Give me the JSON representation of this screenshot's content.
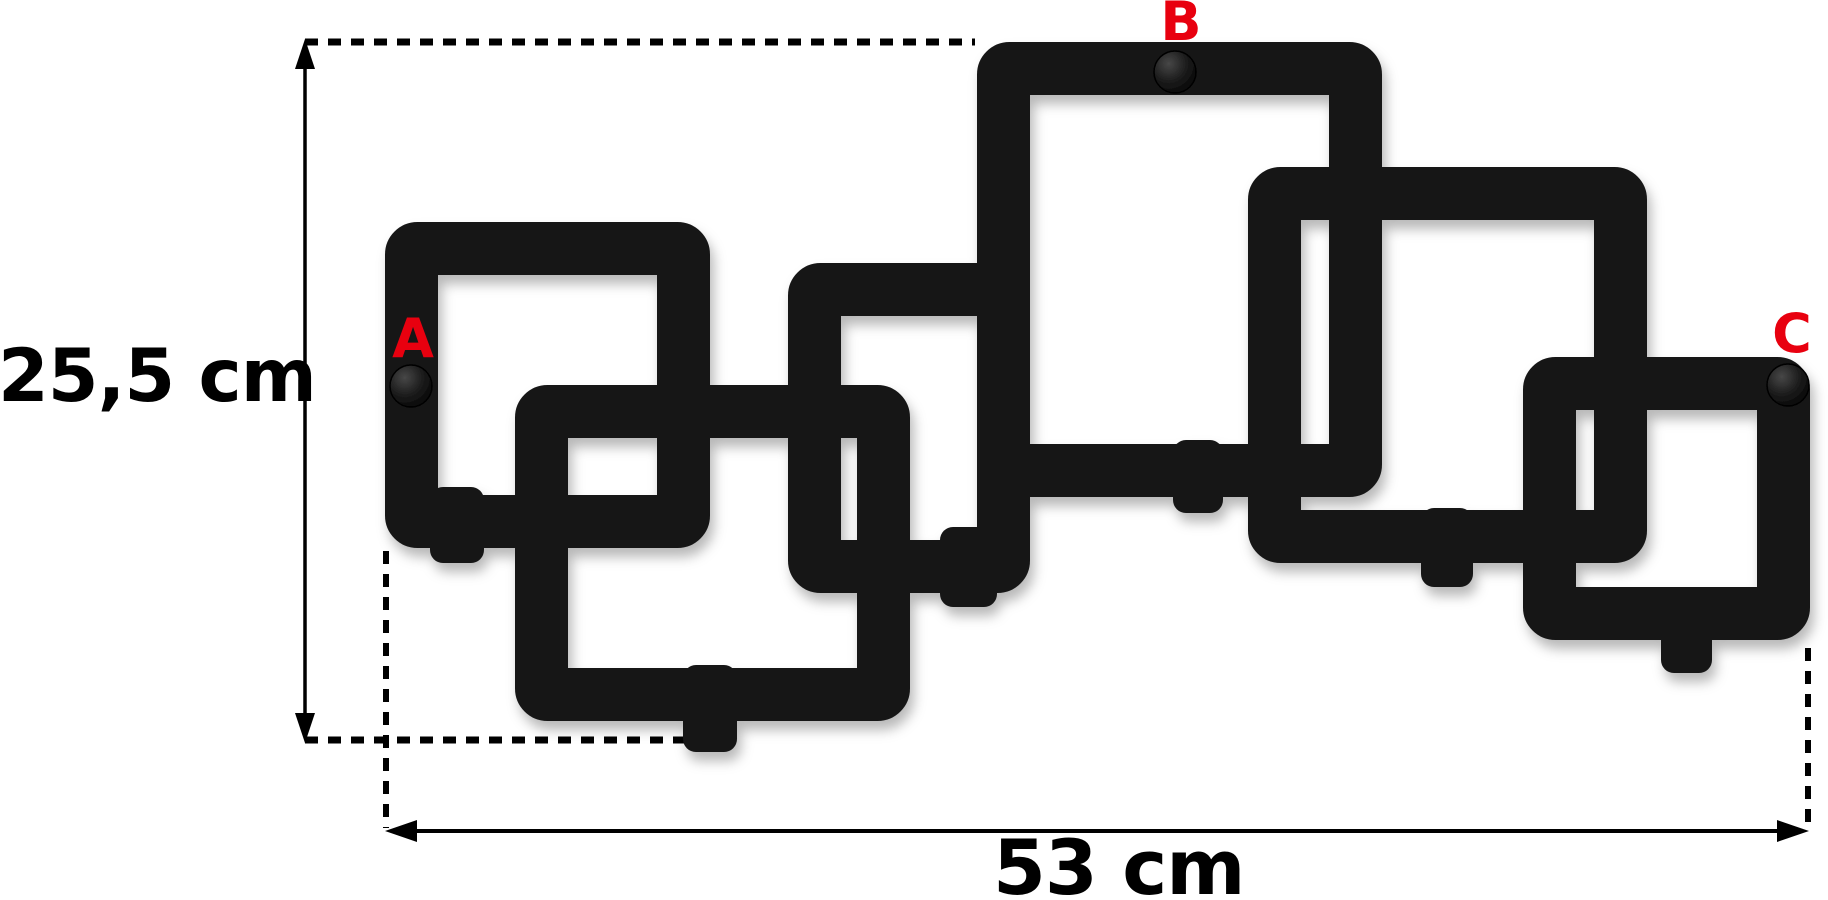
{
  "canvas": {
    "width": 1828,
    "height": 900,
    "background": "#ffffff"
  },
  "colors": {
    "metal": "#161616",
    "label_red": "#e8000f",
    "dimension_line": "#000000",
    "text": "#000000"
  },
  "dimensions": {
    "height_label": "25,5 cm",
    "width_label": "53 cm"
  },
  "mount_points": [
    {
      "label": "A",
      "label_x": 413,
      "label_y": 339,
      "screw_x": 411,
      "screw_y": 386
    },
    {
      "label": "B",
      "label_x": 1181,
      "label_y": 22,
      "screw_x": 1175,
      "screw_y": 72
    },
    {
      "label": "C",
      "label_x": 1792,
      "label_y": 334,
      "screw_x": 1788,
      "screw_y": 385
    }
  ],
  "artwork": {
    "description": "wall coat rack made of six interlocking square frames with hooks",
    "bar_thickness": 53,
    "corner_radius": 6,
    "screw_radius": 21,
    "frames": [
      [
        385,
        222,
        325,
        326
      ],
      [
        515,
        385,
        395,
        336
      ],
      [
        788,
        263,
        242,
        330
      ],
      [
        977,
        42,
        405,
        455
      ],
      [
        1248,
        167,
        399,
        396
      ],
      [
        1523,
        357,
        287,
        283
      ]
    ],
    "hooks": [
      [
        430,
        487,
        54,
        76
      ],
      [
        683,
        665,
        54,
        87
      ],
      [
        940,
        527,
        57,
        80
      ],
      [
        1173,
        440,
        50,
        73
      ],
      [
        1421,
        508,
        52,
        79
      ],
      [
        1661,
        593,
        51,
        80
      ]
    ]
  },
  "dimension_lines": {
    "height_line": {
      "x": 305,
      "y1": 42,
      "y2": 740
    },
    "width_line": {
      "y": 831,
      "x1": 388,
      "x2": 1806
    },
    "extensions": [
      {
        "type": "h",
        "y": 42,
        "x1": 305,
        "x2": 975
      },
      {
        "type": "h",
        "y": 740,
        "x1": 305,
        "x2": 722
      },
      {
        "type": "v",
        "x": 386,
        "y1": 551,
        "y2": 828
      },
      {
        "type": "v",
        "x": 1808,
        "y1": 648,
        "y2": 828
      }
    ]
  }
}
